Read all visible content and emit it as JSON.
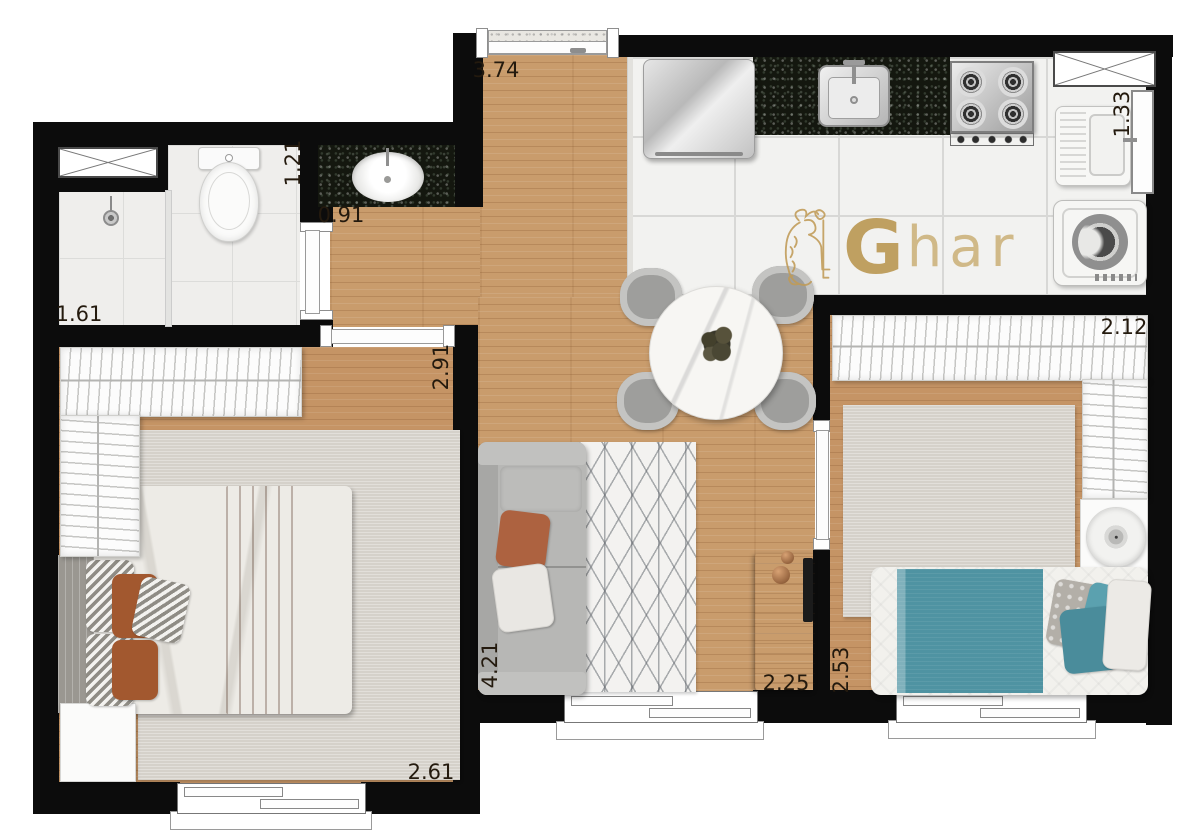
{
  "watermark": {
    "logo": "lion-with-key",
    "brand_bold": "G",
    "brand_rest": "har",
    "gold": "#c09b57"
  },
  "dimensions": {
    "entry_hall_width": "3.74",
    "bathroom_width": "1.21",
    "corridor_width": "0.91",
    "shower_room_width": "1.61",
    "corridor_length": "2.91",
    "service_area_width": "1.33",
    "bedroom2_width": "2.12",
    "bedroom2_length": "2.53",
    "living_room_length": "4.21",
    "living_room_width": "2.25",
    "bedroom1_width": "2.61"
  },
  "palette": {
    "wall": "#0c0c0c",
    "wood_floor": "#c99c6c",
    "white_tile": "#f2f2f0",
    "granite": "#14170f",
    "accent_orange": "#ad6240",
    "accent_teal": "#4f93a2",
    "brand_gold": "#c09b57"
  }
}
